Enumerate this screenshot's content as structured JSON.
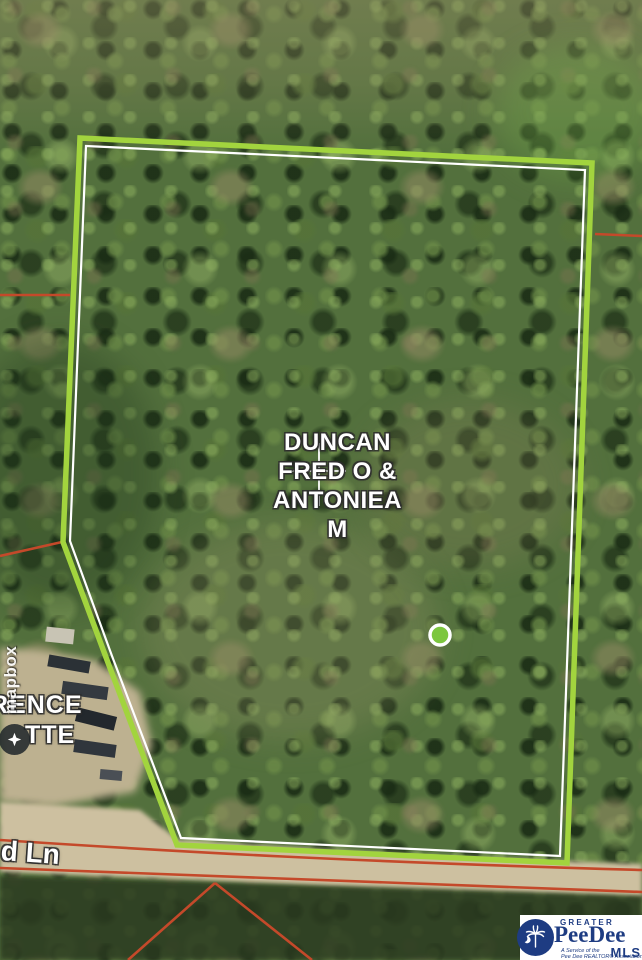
{
  "map": {
    "owner_label": {
      "lines": [
        "DUNCAN",
        "FRED O &",
        "ANTONIEA",
        "M"
      ]
    },
    "partial_owner_label": {
      "line1": "RENCE",
      "line2": "TTE"
    },
    "road_label": "d Ln",
    "marker_color": "#7cc63e",
    "boundary_color": "#a2d43e",
    "parcel_line_color": "#c4492a"
  },
  "attribution": {
    "wordmark": "mapbox"
  },
  "logo": {
    "greater": "GREATER",
    "name": "PeeDee",
    "mls": "MLS",
    "tagline_line1": "A Service of the",
    "tagline_line2": "Pee Dee REALTOR® Association",
    "navy": "#1e3c82"
  }
}
